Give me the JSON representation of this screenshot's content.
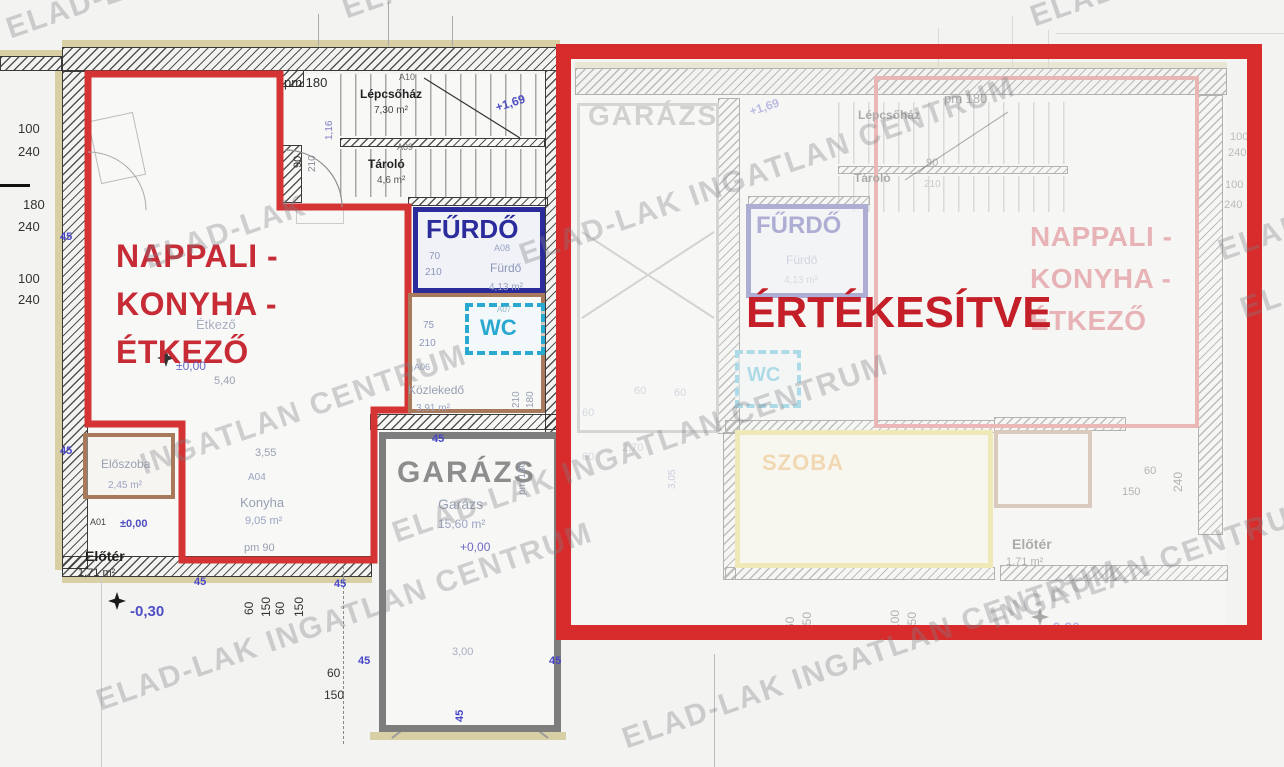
{
  "plan": {
    "sold_banner": "ÉRTÉKESÍTVE",
    "watermark": "ELAD-LAK INGATLAN CENTRUM",
    "left_unit": {
      "living_label_lines": [
        "NAPPALI -",
        "KONYHA -",
        "ÉTKEZŐ"
      ],
      "bathroom_label": "FŰRDŐ",
      "wc_label": "WC",
      "garage_label": "GARÁZS"
    },
    "right_unit": {
      "living_label_lines": [
        "NAPPALI -",
        "KONYHA -",
        "ÉTKEZŐ"
      ],
      "bathroom_label": "FŰRDŐ",
      "wc_label": "WC",
      "garage_label": "GARÁZS",
      "room_label": "SZOBA"
    }
  },
  "colors": {
    "sold_red": "#c41f28",
    "outline_red": "#d43434",
    "navy": "#2b2b9c",
    "cyan": "#29a8d0",
    "brown": "#a8795a",
    "garage_gray": "#8d8d8d",
    "yellow": "#e3d34a",
    "living_red": "#c62b36"
  },
  "annotations": {
    "left": [
      {
        "t": "pm 180",
        "x": 284,
        "y": 76,
        "s": 13,
        "c": "#2a2a2a",
        "n": "sill-height-label"
      },
      {
        "t": "A10",
        "x": 399,
        "y": 73,
        "s": 9,
        "c": "#666"
      },
      {
        "t": "Lépcsőház",
        "x": 360,
        "y": 88,
        "s": 12,
        "c": "#222",
        "b": 1,
        "n": "staircase-label"
      },
      {
        "t": "7,30 m²",
        "x": 374,
        "y": 106,
        "s": 10,
        "c": "#444"
      },
      {
        "t": "A09",
        "x": 397,
        "y": 143,
        "s": 9,
        "c": "#666"
      },
      {
        "t": "Tároló",
        "x": 368,
        "y": 158,
        "s": 12,
        "c": "#222",
        "b": 1,
        "n": "storage-label"
      },
      {
        "t": "4,6 m²",
        "x": 377,
        "y": 176,
        "s": 10,
        "c": "#555"
      },
      {
        "t": "90",
        "x": 293,
        "y": 168,
        "s": 11,
        "c": "#333",
        "r": -90
      },
      {
        "t": "210",
        "x": 308,
        "y": 172,
        "s": 10,
        "c": "#8a8a96",
        "r": -90
      },
      {
        "t": "1,16",
        "x": 325,
        "y": 140,
        "s": 10,
        "c": "#7d7dc0",
        "r": -90
      },
      {
        "t": "+1,69",
        "x": 494,
        "y": 102,
        "s": 12,
        "c": "#4d4dc4",
        "b": 1,
        "r": -18,
        "n": "level-mark"
      },
      {
        "t": "70",
        "x": 429,
        "y": 252,
        "s": 10,
        "c": "#8d97ba"
      },
      {
        "t": "210",
        "x": 425,
        "y": 268,
        "s": 10,
        "c": "#8d97ba"
      },
      {
        "t": "A08",
        "x": 494,
        "y": 244,
        "s": 9,
        "c": "#9aa4c2"
      },
      {
        "t": "Fürdő",
        "x": 490,
        "y": 262,
        "s": 12,
        "c": "#8d97ba"
      },
      {
        "t": "4,13 m²",
        "x": 489,
        "y": 283,
        "s": 10,
        "c": "#9aa4c2"
      },
      {
        "t": "A07",
        "x": 497,
        "y": 306,
        "s": 8,
        "c": "#9ab6ca"
      },
      {
        "t": "75",
        "x": 423,
        "y": 321,
        "s": 10,
        "c": "#8d97ba"
      },
      {
        "t": "210",
        "x": 419,
        "y": 339,
        "s": 10,
        "c": "#8d97ba"
      },
      {
        "t": "A06",
        "x": 414,
        "y": 363,
        "s": 9,
        "c": "#9aa4c2"
      },
      {
        "t": "Közlekedő",
        "x": 408,
        "y": 384,
        "s": 12,
        "c": "#98a0b4"
      },
      {
        "t": "3,91 m²",
        "x": 416,
        "y": 404,
        "s": 10,
        "c": "#9aa4c2"
      },
      {
        "t": "210",
        "x": 512,
        "y": 408,
        "s": 10,
        "c": "#98a0b4",
        "r": -90
      },
      {
        "t": "180",
        "x": 526,
        "y": 408,
        "s": 10,
        "c": "#98a0b4",
        "r": -90
      },
      {
        "t": "Étkező",
        "x": 196,
        "y": 318,
        "s": 13,
        "c": "#a8aec2"
      },
      {
        "t": "±0,00",
        "x": 176,
        "y": 360,
        "s": 12,
        "c": "#6a6ac4"
      },
      {
        "t": "5,40",
        "x": 214,
        "y": 376,
        "s": 11,
        "c": "#9aa0b4"
      },
      {
        "t": "3,55",
        "x": 255,
        "y": 448,
        "s": 11,
        "c": "#9aa0b4"
      },
      {
        "t": "A04",
        "x": 248,
        "y": 473,
        "s": 10,
        "c": "#9aa4c2"
      },
      {
        "t": "Konyha",
        "x": 240,
        "y": 496,
        "s": 13,
        "c": "#98a0b4"
      },
      {
        "t": "9,05 m²",
        "x": 245,
        "y": 516,
        "s": 11,
        "c": "#9aa4c2"
      },
      {
        "t": "pm 90",
        "x": 244,
        "y": 543,
        "s": 11,
        "c": "#98a0b4"
      },
      {
        "t": "Előszoba",
        "x": 101,
        "y": 458,
        "s": 12,
        "c": "#98a0b4"
      },
      {
        "t": "2,45 m²",
        "x": 108,
        "y": 481,
        "s": 10,
        "c": "#9aa4c2"
      },
      {
        "t": "A01",
        "x": 90,
        "y": 518,
        "s": 9,
        "c": "#444"
      },
      {
        "t": "±0,00",
        "x": 120,
        "y": 519,
        "s": 11,
        "c": "#4d4dc4",
        "b": 1
      },
      {
        "t": "Előtér",
        "x": 85,
        "y": 549,
        "s": 14,
        "c": "#222",
        "b": 1,
        "n": "foyer-label"
      },
      {
        "t": "1,71 m²",
        "x": 78,
        "y": 568,
        "s": 11,
        "c": "#333"
      },
      {
        "t": "-0,30",
        "x": 130,
        "y": 604,
        "s": 15,
        "c": "#4d4dc4",
        "b": 1,
        "n": "level-mark"
      },
      {
        "t": "Garázs",
        "x": 438,
        "y": 497,
        "s": 14,
        "c": "#98a0b4"
      },
      {
        "t": "15,60 m²",
        "x": 438,
        "y": 518,
        "s": 12,
        "c": "#9aa4c2"
      },
      {
        "t": "+0,00",
        "x": 460,
        "y": 541,
        "s": 12,
        "c": "#6a6ac4"
      },
      {
        "t": "3,00",
        "x": 452,
        "y": 647,
        "s": 11,
        "c": "#a8aec2"
      },
      {
        "t": "pm 180",
        "x": 518,
        "y": 495,
        "s": 10,
        "c": "#98a0b4",
        "r": -90
      },
      {
        "t": "100",
        "x": 18,
        "y": 122,
        "s": 13,
        "c": "#333"
      },
      {
        "t": "240",
        "x": 18,
        "y": 145,
        "s": 13,
        "c": "#333"
      },
      {
        "t": "180",
        "x": 23,
        "y": 198,
        "s": 13,
        "c": "#333"
      },
      {
        "t": "240",
        "x": 18,
        "y": 220,
        "s": 13,
        "c": "#333"
      },
      {
        "t": "100",
        "x": 18,
        "y": 272,
        "s": 13,
        "c": "#333"
      },
      {
        "t": "240",
        "x": 18,
        "y": 293,
        "s": 13,
        "c": "#333"
      },
      {
        "t": "60",
        "x": 243,
        "y": 615,
        "s": 12,
        "c": "#333",
        "r": -90
      },
      {
        "t": "150",
        "x": 260,
        "y": 617,
        "s": 12,
        "c": "#333",
        "r": -90
      },
      {
        "t": "60",
        "x": 274,
        "y": 615,
        "s": 12,
        "c": "#333",
        "r": -90
      },
      {
        "t": "150",
        "x": 293,
        "y": 617,
        "s": 12,
        "c": "#333",
        "r": -90
      },
      {
        "t": "60",
        "x": 327,
        "y": 667,
        "s": 12,
        "c": "#333"
      },
      {
        "t": "150",
        "x": 324,
        "y": 689,
        "s": 12,
        "c": "#333"
      },
      {
        "t": "45",
        "x": 60,
        "y": 232,
        "s": 11,
        "c": "#4646c8",
        "b": 1
      },
      {
        "t": "45",
        "x": 60,
        "y": 446,
        "s": 11,
        "c": "#4646c8",
        "b": 1
      },
      {
        "t": "45",
        "x": 194,
        "y": 577,
        "s": 11,
        "c": "#4646c8",
        "b": 1
      },
      {
        "t": "45",
        "x": 334,
        "y": 579,
        "s": 11,
        "c": "#4646c8",
        "b": 1
      },
      {
        "t": "45",
        "x": 358,
        "y": 656,
        "s": 11,
        "c": "#4646c8",
        "b": 1
      },
      {
        "t": "45",
        "x": 549,
        "y": 656,
        "s": 11,
        "c": "#4646c8",
        "b": 1
      },
      {
        "t": "45",
        "x": 432,
        "y": 434,
        "s": 11,
        "c": "#4646c8",
        "b": 1
      },
      {
        "t": "45",
        "x": 455,
        "y": 722,
        "s": 11,
        "c": "#4646c8",
        "b": 1,
        "r": -90
      }
    ],
    "right": [
      {
        "t": "pm 180",
        "x": 944,
        "y": 92,
        "s": 13,
        "c": "#2a2a2a",
        "n": "sill-height-label"
      },
      {
        "t": "Lépcsőház",
        "x": 858,
        "y": 109,
        "s": 12,
        "c": "#222",
        "b": 1,
        "n": "staircase-label"
      },
      {
        "t": "Tároló",
        "x": 854,
        "y": 172,
        "s": 12,
        "c": "#222",
        "b": 1,
        "n": "storage-label"
      },
      {
        "t": "90",
        "x": 926,
        "y": 158,
        "s": 11,
        "c": "#333"
      },
      {
        "t": "210",
        "x": 924,
        "y": 180,
        "s": 10,
        "c": "#777"
      },
      {
        "t": "+1,69",
        "x": 748,
        "y": 106,
        "s": 12,
        "c": "#4d4dc4",
        "b": 1,
        "r": -18,
        "n": "level-mark"
      },
      {
        "t": "Fürdő",
        "x": 786,
        "y": 254,
        "s": 12,
        "c": "#8d97ba"
      },
      {
        "t": "4,13 m²",
        "x": 784,
        "y": 276,
        "s": 10,
        "c": "#9aa4c2"
      },
      {
        "t": "Előtér",
        "x": 1012,
        "y": 537,
        "s": 14,
        "c": "#222",
        "b": 1,
        "n": "foyer-label"
      },
      {
        "t": "1,71 m²",
        "x": 1006,
        "y": 557,
        "s": 11,
        "c": "#333"
      },
      {
        "t": "-0,30",
        "x": 1048,
        "y": 620,
        "s": 14,
        "c": "#4d4dc4",
        "b": 1,
        "n": "level-mark"
      },
      {
        "t": "240",
        "x": 1172,
        "y": 492,
        "s": 12,
        "c": "#333",
        "r": -90
      },
      {
        "t": "60",
        "x": 1144,
        "y": 466,
        "s": 11,
        "c": "#333"
      },
      {
        "t": "150",
        "x": 1122,
        "y": 487,
        "s": 11,
        "c": "#333"
      },
      {
        "t": "60",
        "x": 784,
        "y": 630,
        "s": 12,
        "c": "#333",
        "r": -90
      },
      {
        "t": "150",
        "x": 801,
        "y": 632,
        "s": 12,
        "c": "#333",
        "r": -90
      },
      {
        "t": "100",
        "x": 889,
        "y": 630,
        "s": 12,
        "c": "#333",
        "r": -90
      },
      {
        "t": "150",
        "x": 906,
        "y": 632,
        "s": 12,
        "c": "#333",
        "r": -90
      },
      {
        "t": "2,70",
        "x": 622,
        "y": 443,
        "s": 11,
        "c": "#98a0b4"
      },
      {
        "t": "3,05",
        "x": 668,
        "y": 489,
        "s": 10,
        "c": "#7d7dc0",
        "r": -90
      },
      {
        "t": "60",
        "x": 634,
        "y": 386,
        "s": 11,
        "c": "#98a0b4"
      },
      {
        "t": "60",
        "x": 582,
        "y": 408,
        "s": 11,
        "c": "#98a0b4"
      },
      {
        "t": "60",
        "x": 582,
        "y": 452,
        "s": 11,
        "c": "#98a0b4"
      },
      {
        "t": "60",
        "x": 674,
        "y": 388,
        "s": 11,
        "c": "#98a0b4"
      },
      {
        "t": "100",
        "x": 1230,
        "y": 132,
        "s": 11,
        "c": "#555"
      },
      {
        "t": "240",
        "x": 1228,
        "y": 148,
        "s": 11,
        "c": "#555"
      },
      {
        "t": "100",
        "x": 1225,
        "y": 180,
        "s": 11,
        "c": "#555"
      },
      {
        "t": "240",
        "x": 1224,
        "y": 200,
        "s": 11,
        "c": "#555"
      }
    ],
    "watermarks": [
      {
        "t": "ELAD-LAK",
        "x": 2,
        "y": 14
      },
      {
        "t": "ELAD-LAK",
        "x": 338,
        "y": -6
      },
      {
        "t": "ELAD-LAK",
        "x": 1026,
        "y": 2
      },
      {
        "t": "ELAD-LAK INGATLAN CENTRUM",
        "x": 515,
        "y": 240
      },
      {
        "t": "ELAD-LAK",
        "x": 140,
        "y": 244
      },
      {
        "t": "ELAD-",
        "x": 1214,
        "y": 236
      },
      {
        "t": "INGATLAN CENTRUM",
        "x": 136,
        "y": 450
      },
      {
        "t": "ELAD-LAK INGATLAN CENTRUM",
        "x": 388,
        "y": 518
      },
      {
        "t": "ELAD-LAK INGATLAN CENTRUM",
        "x": 92,
        "y": 686
      },
      {
        "t": "ELAD-LAK INGATLAN CENTRUM",
        "x": 618,
        "y": 724
      },
      {
        "t": "INGATLAN CENTRUM",
        "x": 986,
        "y": 604
      },
      {
        "t": "ELAD",
        "x": 1236,
        "y": 294
      }
    ]
  }
}
